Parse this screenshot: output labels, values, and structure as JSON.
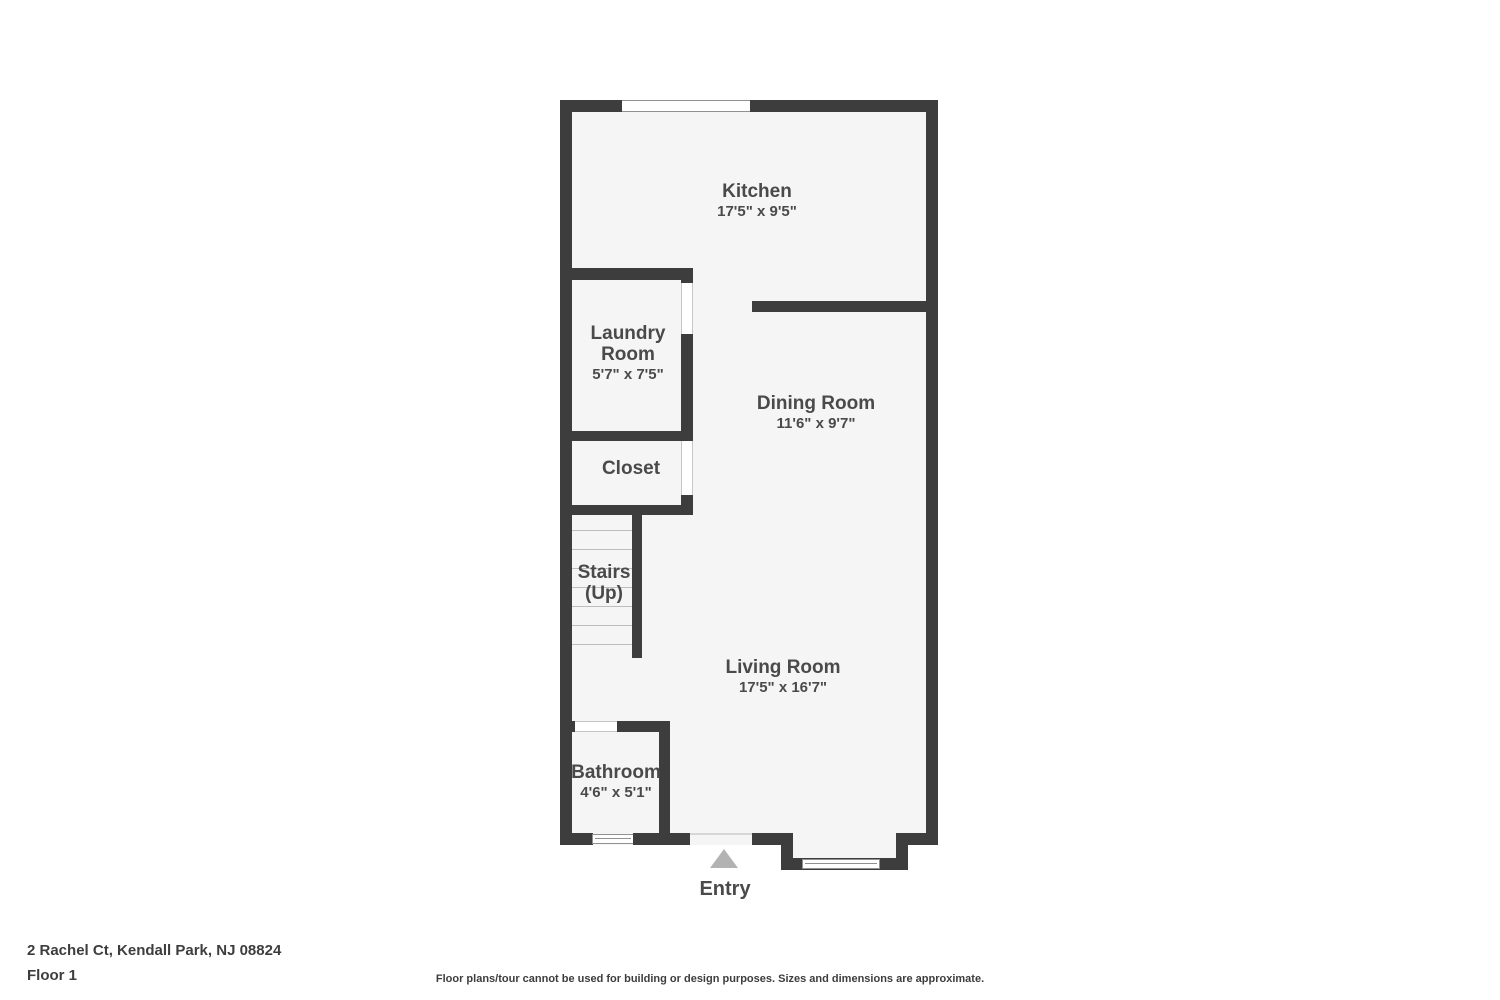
{
  "page": {
    "address": "2 Rachel Ct, Kendall Park, NJ 08824",
    "floor": "Floor 1",
    "disclaimer": "Floor plans/tour cannot be used for building or design purposes. Sizes and dimensions are approximate."
  },
  "plan": {
    "entry_label": "Entry",
    "rooms": {
      "kitchen": {
        "name": "Kitchen",
        "dims": "17'5\" x 9'5\""
      },
      "laundry": {
        "line1": "Laundry",
        "line2": "Room",
        "dims": "5'7\" x 7'5\""
      },
      "closet": {
        "name": "Closet"
      },
      "dining": {
        "name": "Dining Room",
        "dims": "11'6\" x 9'7\""
      },
      "stairs": {
        "line1": "Stairs",
        "line2": "(Up)"
      },
      "living": {
        "name": "Living Room",
        "dims": "17'5\" x 16'7\""
      },
      "bathroom": {
        "name": "Bathroom",
        "dims": "4'6\" x 5'1\""
      }
    },
    "colors": {
      "wall": "#3d3d3d",
      "floor": "#f5f5f5",
      "label": "#4a4a4a",
      "arrow": "#b3b3b3",
      "step_line": "#bdbdbd",
      "window_frame": "#919191"
    }
  }
}
